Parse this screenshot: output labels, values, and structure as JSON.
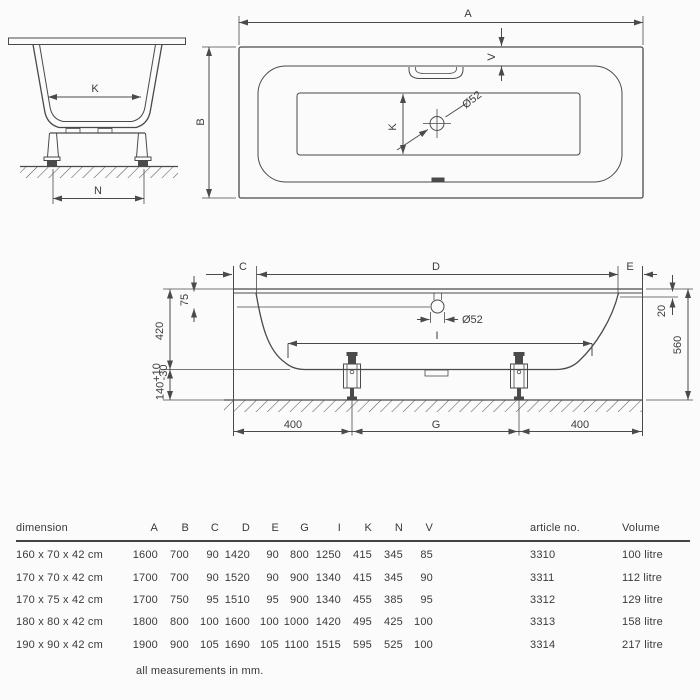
{
  "colors": {
    "line": "#4a4a4a",
    "text": "#3c3c3c",
    "rule": "#424242",
    "background": "#fbfbfb"
  },
  "drawing": {
    "side": {
      "k": "K",
      "n": "N"
    },
    "plan": {
      "a": "A",
      "b": "B",
      "v": "V",
      "k": "K",
      "drain": "Ø52"
    },
    "section": {
      "c": "C",
      "d": "D",
      "e": "E",
      "i": "I",
      "g": "G",
      "h75": "75",
      "h420": "420",
      "h140": "140",
      "tol_plus": "+10",
      "tol_minus": "-30",
      "edge20": "20",
      "total560": "560",
      "left400": "400",
      "right400": "400",
      "drain": "Ø52"
    }
  },
  "table": {
    "headers": {
      "dimension": "dimension",
      "a": "A",
      "b": "B",
      "c": "C",
      "d": "D",
      "e": "E",
      "g": "G",
      "i": "I",
      "k": "K",
      "n": "N",
      "v": "V",
      "article": "article no.",
      "volume": "Volume"
    },
    "rows": [
      {
        "dim": "160 x 70 x 42 cm",
        "a": "1600",
        "b": "700",
        "c": "90",
        "d": "1420",
        "e": "90",
        "g": "800",
        "i": "1250",
        "k": "415",
        "n": "345",
        "v": "85",
        "article": "3310",
        "volume": "100 litre"
      },
      {
        "dim": "170 x 70 x 42 cm",
        "a": "1700",
        "b": "700",
        "c": "90",
        "d": "1520",
        "e": "90",
        "g": "900",
        "i": "1340",
        "k": "415",
        "n": "345",
        "v": "90",
        "article": "3311",
        "volume": "112 litre"
      },
      {
        "dim": "170 x 75 x 42 cm",
        "a": "1700",
        "b": "750",
        "c": "95",
        "d": "1510",
        "e": "95",
        "g": "900",
        "i": "1340",
        "k": "455",
        "n": "385",
        "v": "95",
        "article": "3312",
        "volume": "129 litre"
      },
      {
        "dim": "180 x 80 x 42 cm",
        "a": "1800",
        "b": "800",
        "c": "100",
        "d": "1600",
        "e": "100",
        "g": "1000",
        "i": "1420",
        "k": "495",
        "n": "425",
        "v": "100",
        "article": "3313",
        "volume": "158 litre"
      },
      {
        "dim": "190 x 90 x 42 cm",
        "a": "1900",
        "b": "900",
        "c": "105",
        "d": "1690",
        "e": "105",
        "g": "1100",
        "i": "1515",
        "k": "595",
        "n": "525",
        "v": "100",
        "article": "3314",
        "volume": "217 litre"
      }
    ],
    "footnote": "all measurements in mm."
  }
}
